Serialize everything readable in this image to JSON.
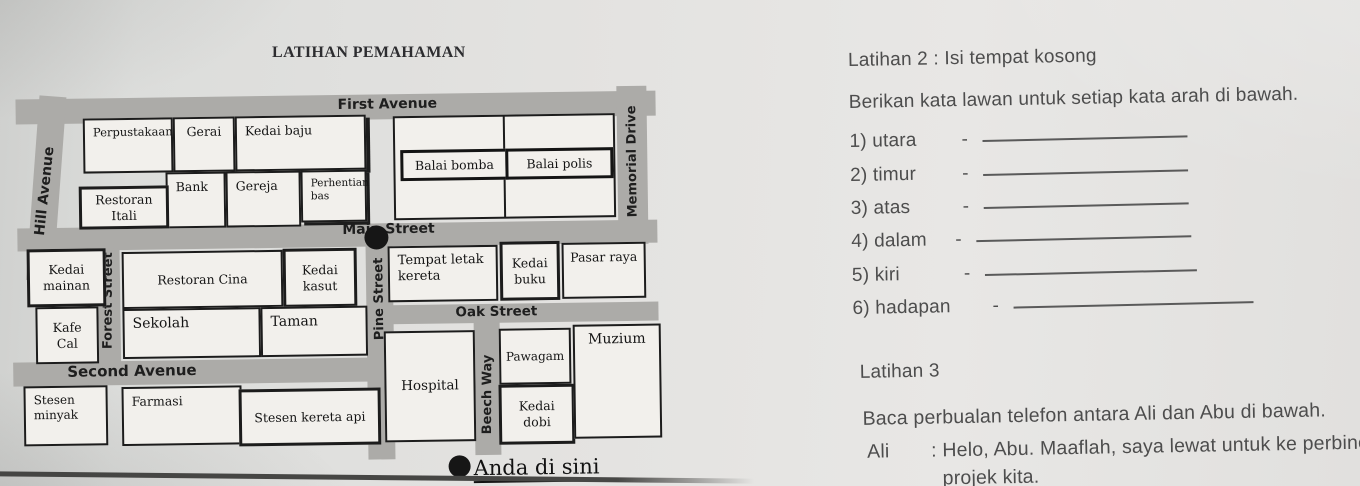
{
  "page": {
    "title": "LATIHAN PEMAHAMAN"
  },
  "map": {
    "streets": {
      "first_avenue": "First Avenue",
      "hill_avenue": "Hill Avenue",
      "memorial_drive": "Memorial Drive",
      "main_street": "Main Street",
      "forest_street": "Forest Street",
      "pine_street": "Pine Street",
      "oak_street": "Oak Street",
      "second_avenue": "Second Avenue",
      "beech_way": "Beech Way"
    },
    "buildings": {
      "perpustakaan": "Perpustakaan",
      "gerai": "Gerai",
      "kedai_baju": "Kedai baju",
      "bank": "Bank",
      "gereja": "Gereja",
      "perhentian_bas": "Perhentian bas",
      "restoran_itali": "Restoran Itali",
      "balai_bomba": "Balai bomba",
      "balai_polis": "Balai polis",
      "kedai_mainan": "Kedai mainan",
      "kafe_cal": "Kafe Cal",
      "restoran_cina": "Restoran Cina",
      "kedai_kasut": "Kedai kasut",
      "sekolah": "Sekolah",
      "taman": "Taman",
      "tempat_letak_kereta": "Tempat letak kereta",
      "kedai_buku": "Kedai buku",
      "pasar_raya": "Pasar raya",
      "hospital": "Hospital",
      "pawagam": "Pawagam",
      "muzium": "Muzium",
      "kedai_dobi": "Kedai dobi",
      "stesen_minyak": "Stesen minyak",
      "farmasi": "Farmasi",
      "stesen_kereta_api": "Stesen kereta api"
    },
    "you_are_here_label": "Anda di sini"
  },
  "exercise2": {
    "heading": "Latihan 2 : Isi tempat kosong",
    "instruction": "Berikan kata lawan untuk setiap kata arah di bawah.",
    "items": [
      {
        "num": "1)",
        "word": "utara",
        "dash": "-"
      },
      {
        "num": "2)",
        "word": "timur",
        "dash": "-"
      },
      {
        "num": "3)",
        "word": "atas",
        "dash": "-"
      },
      {
        "num": "4)",
        "word": "dalam",
        "dash": "-"
      },
      {
        "num": "5)",
        "word": "kiri",
        "dash": "-"
      },
      {
        "num": "6)",
        "word": "hadapan",
        "dash": "-"
      }
    ]
  },
  "exercise3": {
    "heading": "Latihan 3",
    "instruction": "Baca perbualan telefon antara Ali dan Abu di bawah.",
    "dialog": {
      "speaker": "Ali",
      "colon": ":",
      "line1": "Helo, Abu. Maaflah, saya lewat untuk ke perbinc",
      "line2": "projek kita."
    }
  },
  "colors": {
    "paper": "#e3e2e0",
    "road_gray": "#acaba8",
    "building_fill": "#f2f0ec",
    "ink": "#1c1c1c",
    "handout_text": "#4d4d4d"
  }
}
